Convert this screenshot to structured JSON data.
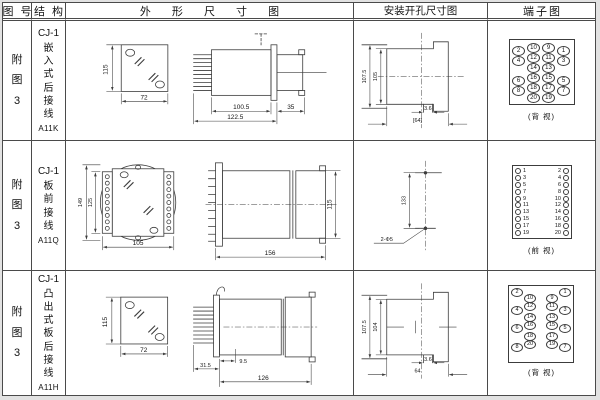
{
  "header": {
    "figure": "图 号",
    "structure": "结 构",
    "outline": "外 形 尺 寸 图",
    "mounting": "安装开孔尺寸图",
    "terminal": "端子图"
  },
  "rows": [
    {
      "figure": "附图3",
      "model": "CJ-1",
      "desc": "嵌入式后接线",
      "code": "A11K",
      "outline": {
        "front_h": "115",
        "front_w": "72",
        "len_body": "100.5",
        "len_total": "122.5",
        "len_rear": "35"
      },
      "mounting": {
        "outer_h": "107.5",
        "inner_h": "105",
        "notch_w": "3.6",
        "cut_w": "[64]"
      },
      "terminal": {
        "view": "(背 视)",
        "grid": [
          [
            "2",
            "10",
            "9",
            "1"
          ],
          [
            "4",
            "12",
            "11",
            "3"
          ],
          [
            null,
            "14",
            "13",
            null
          ],
          [
            "6",
            "16",
            "15",
            "5"
          ],
          [
            "8",
            "18",
            "17",
            "7"
          ],
          [
            null,
            "20",
            "19",
            null
          ]
        ]
      }
    },
    {
      "figure": "附图3",
      "model": "CJ-1",
      "desc": "板前接线",
      "code": "A11Q",
      "outline": {
        "front_h": "149",
        "plate_h": "125",
        "front_w": "105",
        "side_len": "156",
        "side_h": "115"
      },
      "mounting": {
        "hole_dist": "133",
        "hole_spec": "2-Φ5"
      },
      "terminal": {
        "view": "(前 视)",
        "left": [
          "1",
          "3",
          "5",
          "7",
          "9",
          "11",
          "13",
          "15",
          "17",
          "19"
        ],
        "right": [
          "2",
          "4",
          "6",
          "8",
          "10",
          "12",
          "14",
          "16",
          "18",
          "20"
        ]
      }
    },
    {
      "figure": "附图3",
      "model": "CJ-1",
      "desc": "凸出式板后接线",
      "code": "A11H",
      "outline": {
        "front_h": "115",
        "front_w": "72",
        "len_front": "31.5",
        "len_panel": "9.5",
        "len_body": "126"
      },
      "mounting": {
        "outer_h": "107.5",
        "inner_h": "104",
        "notch_w": "3.6",
        "cut_w": "64"
      },
      "terminal": {
        "view": "(背 视)",
        "left_outer": [
          "2",
          "4",
          "6",
          "8"
        ],
        "left_inner": [
          "10",
          "12",
          "14",
          "16",
          "18",
          "20"
        ],
        "right_inner": [
          "9",
          "11",
          "13",
          "15",
          "17",
          "19"
        ],
        "right_outer": [
          "1",
          "3",
          "5",
          "7"
        ]
      }
    }
  ]
}
